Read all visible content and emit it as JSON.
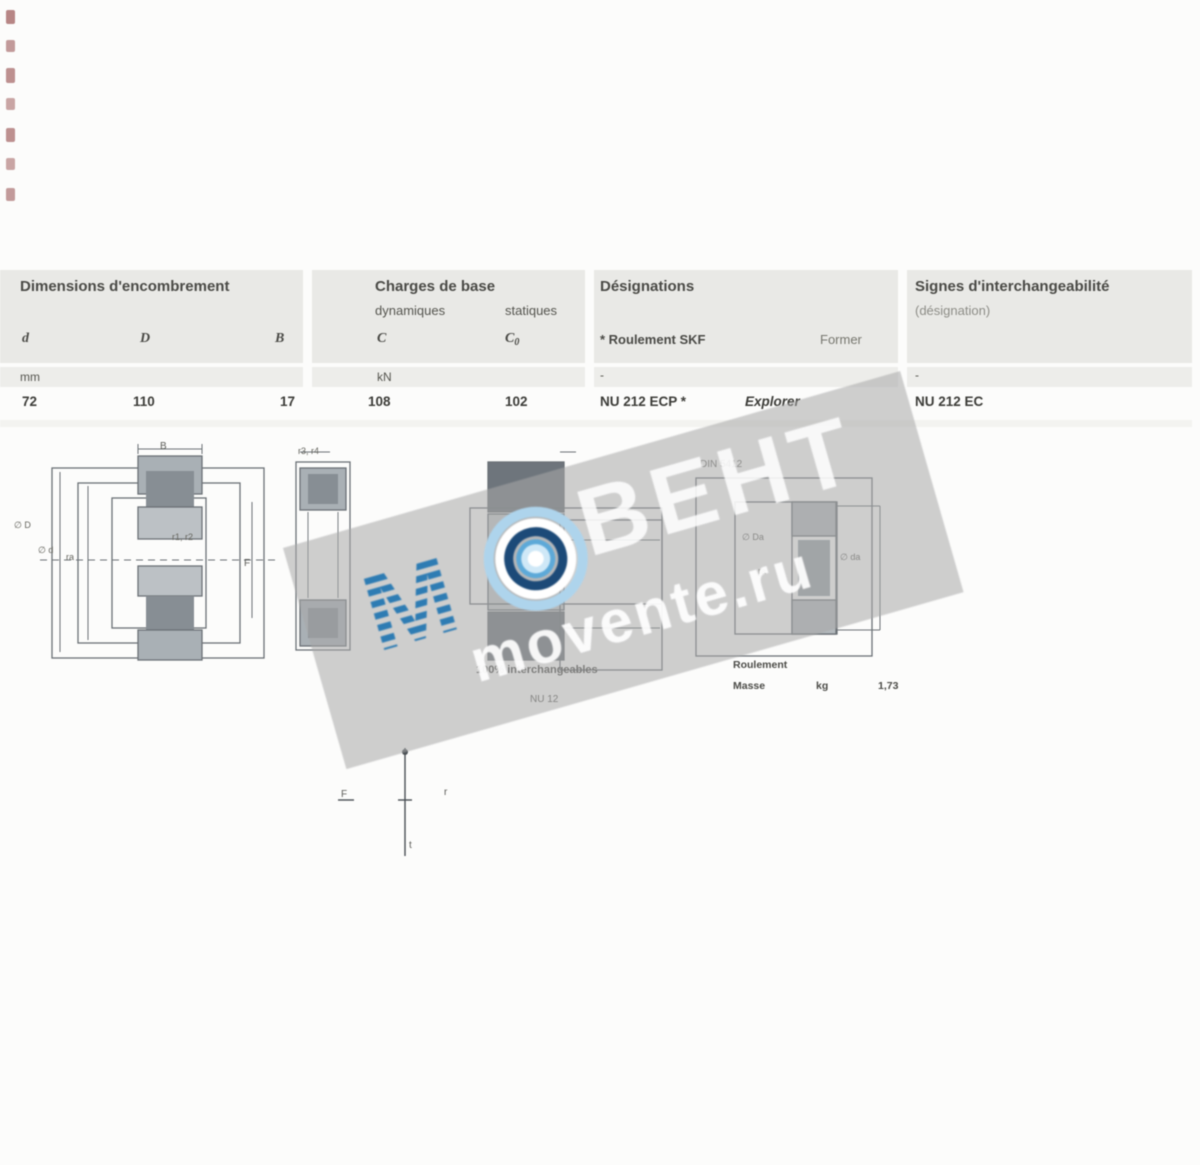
{
  "page": {
    "background": "#fcfcfb"
  },
  "table": {
    "header": {
      "dimensions_title": "Dimensions d'encombrement",
      "loads_title": "Charges de base",
      "loads_sub_dynamic": "dynamiques",
      "loads_sub_static": "statiques",
      "designations_title": "Désignations",
      "designations_sub_skf": "* Roulement SKF",
      "designations_sub_former": "Former",
      "interchange_title": "Signes d'interchangeabilité",
      "interchange_sub": "(désignation)",
      "col_d": "d",
      "col_D": "D",
      "col_B": "B",
      "col_C": "C",
      "col_C0_main": "C",
      "col_C0_sub": "0",
      "unit_mm": "mm",
      "unit_kN": "kN",
      "unit_dash_1": "-",
      "unit_dash_2": "-"
    },
    "row": {
      "d": "72",
      "D": "110",
      "B": "17",
      "C": "108",
      "C0": "102",
      "designation_skf": "NU 212 ECP *",
      "designation_former": "Explorer",
      "interchange": "NU 212 EC"
    }
  },
  "drawings": {
    "left": {
      "b": "B",
      "dia_D": "∅ D",
      "dia_d": "∅ d",
      "f": "F",
      "r12": "r1, r2",
      "ra": "ra"
    },
    "side": {
      "r34": "r3, r4"
    },
    "middle": {
      "caption": "100% interchangeables",
      "sub": "NU 12"
    },
    "right": {
      "standard": "DIN 5412",
      "dia_Da": "∅ Da",
      "ra": "ra",
      "dia_da": "∅ da",
      "caption": "Roulement",
      "mass_label": "Masse",
      "mass_unit": "kg",
      "mass_value": "1,73"
    },
    "axis": {
      "left": "F",
      "right": "r",
      "bottom": "t"
    }
  },
  "watermark": {
    "word_m": "М",
    "word_rest": "ВЕНТ",
    "site": "movente.ru",
    "stripe_blue": "#2e7cb3",
    "ring_light": "#aed4ec",
    "ring_navy": "#1c4a78"
  }
}
